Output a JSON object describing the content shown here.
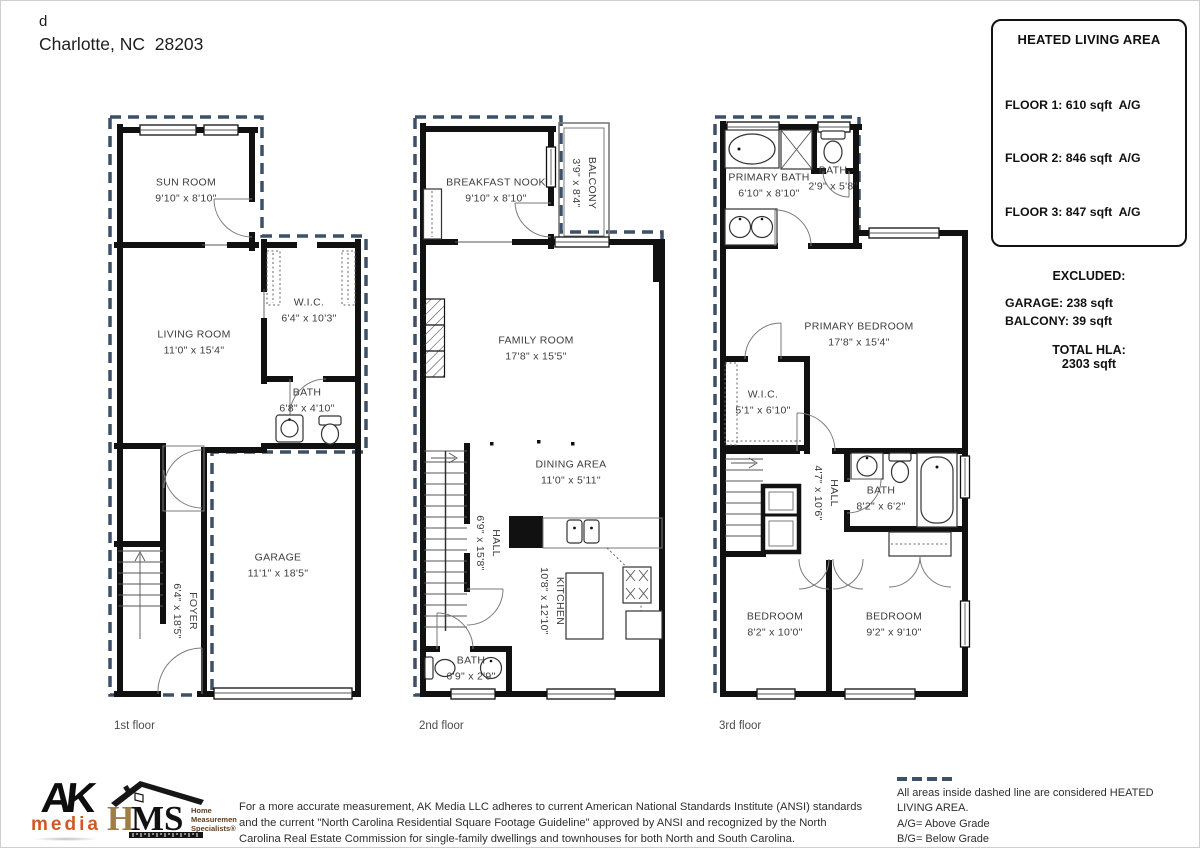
{
  "header": {
    "line1": "d",
    "line2": "Charlotte, NC  28203"
  },
  "hla_box": {
    "title": "HEATED LIVING AREA",
    "floors": [
      "FLOOR 1: 610 sqft  A/G",
      "FLOOR 2: 846 sqft  A/G",
      "FLOOR 3: 847 sqft  A/G"
    ],
    "excluded_label": "EXCLUDED:",
    "excluded": [
      "GARAGE: 238 sqft",
      "BALCONY: 39 sqft"
    ],
    "total_label": "TOTAL HLA:",
    "total_value": "2303 sqft"
  },
  "floors": [
    {
      "caption": "1st floor",
      "rooms": [
        {
          "name": "SUN ROOM",
          "dims": "9'10\" x 8'10\""
        },
        {
          "name": "LIVING ROOM",
          "dims": "11'0\" x 15'4\""
        },
        {
          "name": "W.I.C.",
          "dims": "6'4\" x 10'3\""
        },
        {
          "name": "BATH",
          "dims": "6'8\" x 4'10\""
        },
        {
          "name": "GARAGE",
          "dims": "11'1\" x 18'5\""
        },
        {
          "name": "FOYER",
          "dims": "6'4\" x 18'5\""
        }
      ]
    },
    {
      "caption": "2nd floor",
      "rooms": [
        {
          "name": "BREAKFAST NOOK",
          "dims": "9'10\" x 8'10\""
        },
        {
          "name": "BALCONY",
          "dims": "3'9\" x 8'4\""
        },
        {
          "name": "FAMILY ROOM",
          "dims": "17'8\" x 15'5\""
        },
        {
          "name": "DINING AREA",
          "dims": "11'0\" x 5'11\""
        },
        {
          "name": "HALL",
          "dims": "6'9\" x 15'8\""
        },
        {
          "name": "KITCHEN",
          "dims": "10'8\" x 12'10\""
        },
        {
          "name": "BATH",
          "dims": "6'9\" x 2'9\""
        }
      ]
    },
    {
      "caption": "3rd floor",
      "rooms": [
        {
          "name": "PRIMARY BATH",
          "dims": "6'10\" x 8'10\""
        },
        {
          "name": "BATH",
          "dims": "2'9\" x 5'8\""
        },
        {
          "name": "PRIMARY BEDROOM",
          "dims": "17'8\" x 15'4\""
        },
        {
          "name": "W.I.C.",
          "dims": "5'1\" x 6'10\""
        },
        {
          "name": "HALL",
          "dims": "4'7\" x 10'6\""
        },
        {
          "name": "BATH",
          "dims": "8'2\" x 6'2\""
        },
        {
          "name": "BEDROOM",
          "dims": "8'2\" x 10'0\""
        },
        {
          "name": "BEDROOM",
          "dims": "9'2\" x 9'10\""
        }
      ]
    }
  ],
  "footer": {
    "ak_logo": {
      "line1": "AK",
      "line2": "media"
    },
    "hms_logo": {
      "h": "H",
      "ms": "MS",
      "tagline": [
        "Home",
        "Measurement",
        "Specialists®"
      ]
    },
    "disclaimer": "For a more accurate measurement, AK Media LLC adheres to current American National Standards Institute (ANSI) standards and the current \"North Carolina Residential Square Footage Guideline\" approved by ANSI and recognized by the North Carolina Real Estate Commission for single-family dwellings and townhouses for both North and South Carolina.",
    "notes": [
      "All areas inside dashed line are considered HEATED LIVING AREA.",
      "A/G= Above Grade",
      "B/G= Below Grade",
      "FINAL HLA IS ROUNDED TO NEAREST FOOT"
    ]
  },
  "colors": {
    "dashed_boundary": "#3e4f68",
    "wall": "#111111",
    "label_text": "#3d3d3d",
    "ak_accent": "#cf5a28",
    "hms_gold": "#9e7e44",
    "hms_brown": "#5d3d20"
  }
}
